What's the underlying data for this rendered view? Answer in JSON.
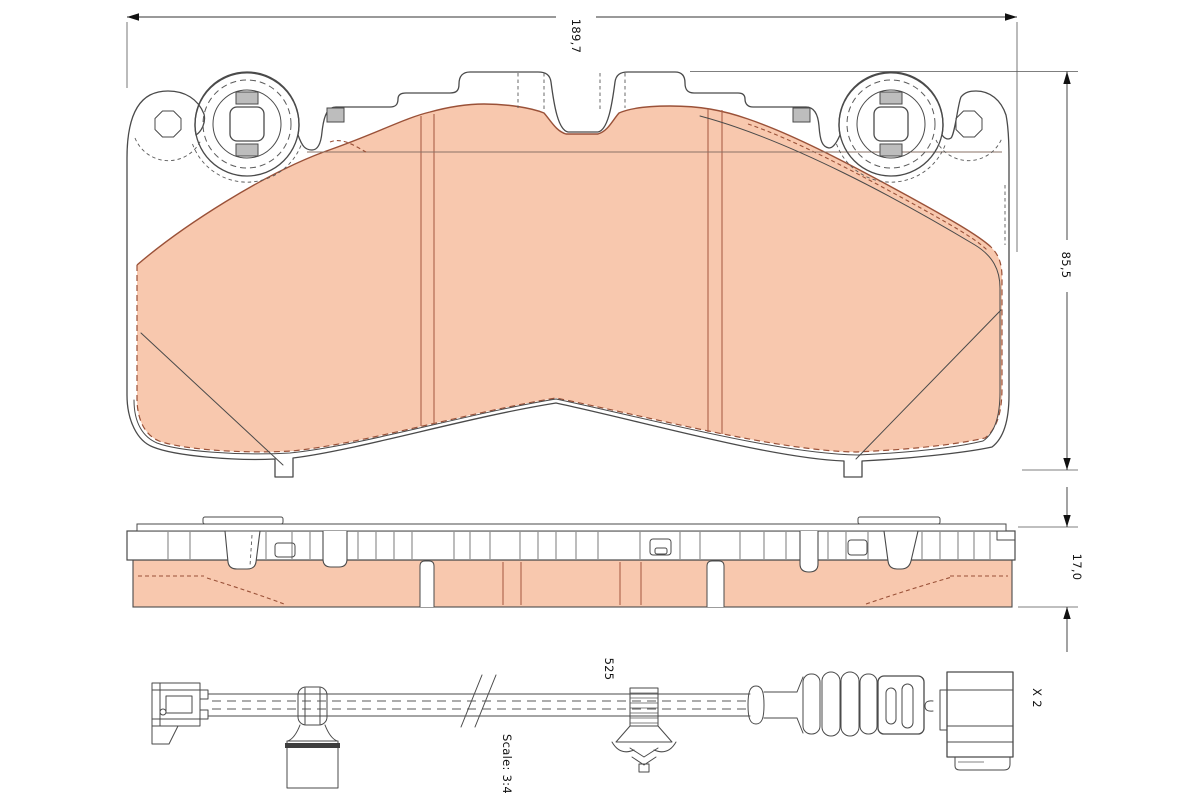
{
  "drawing": {
    "dimensions": {
      "width_label": "189,7",
      "height_label": "85,5",
      "thickness_label": "17,0",
      "sensor_length_label": "525",
      "quantity_label": "X 2",
      "scale_label": "Scale: 3:4"
    },
    "colors": {
      "friction_fill": "#f8c8ae",
      "friction_edge": "#9a5138",
      "outline": "#4a4a4a",
      "dimension_line": "#333333",
      "background": "#ffffff"
    }
  }
}
